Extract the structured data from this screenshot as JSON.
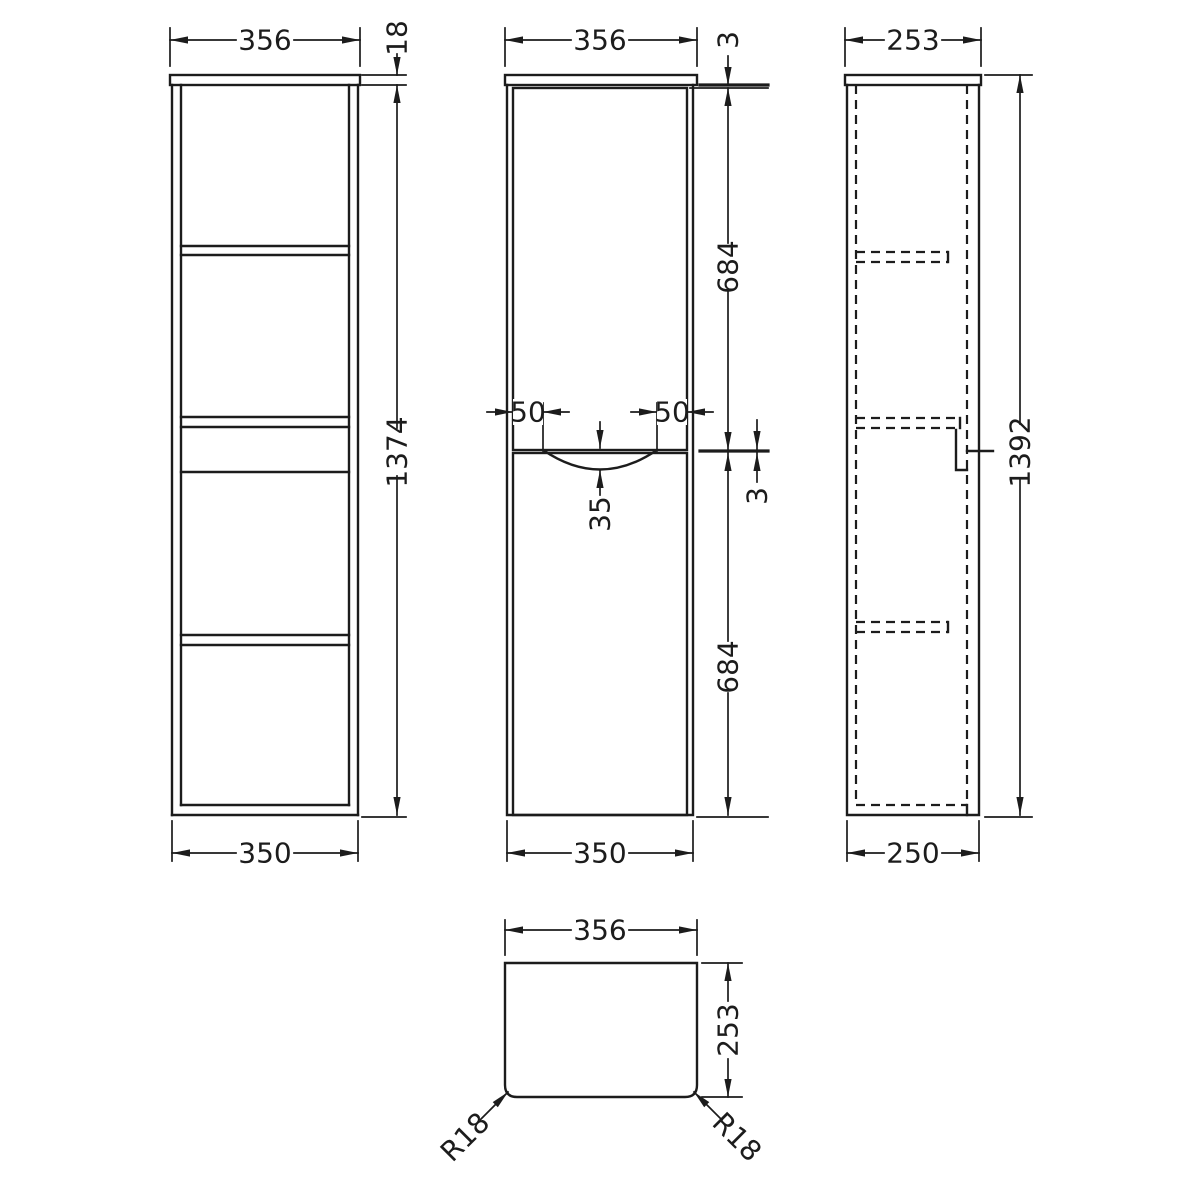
{
  "drawing": {
    "background_color": "#ffffff",
    "line_color": "#1c1c1c",
    "views": {
      "front_carcass": {
        "width_top": "356",
        "top_panel_thickness": "18",
        "overall_height": "1374",
        "width_bottom": "350"
      },
      "front_doors": {
        "width_top": "356",
        "top_gap": "3",
        "upper_door_height": "684",
        "handle_inset_left": "50",
        "handle_inset_right": "50",
        "handle_recess_depth": "35",
        "door_gap": "3",
        "lower_door_height": "684",
        "width_bottom": "350"
      },
      "side": {
        "depth_top": "253",
        "overall_height": "1392",
        "depth_bottom": "250"
      },
      "plan": {
        "width": "356",
        "depth": "253",
        "corner_radius_left": "R18",
        "corner_radius_right": "R18"
      }
    }
  }
}
